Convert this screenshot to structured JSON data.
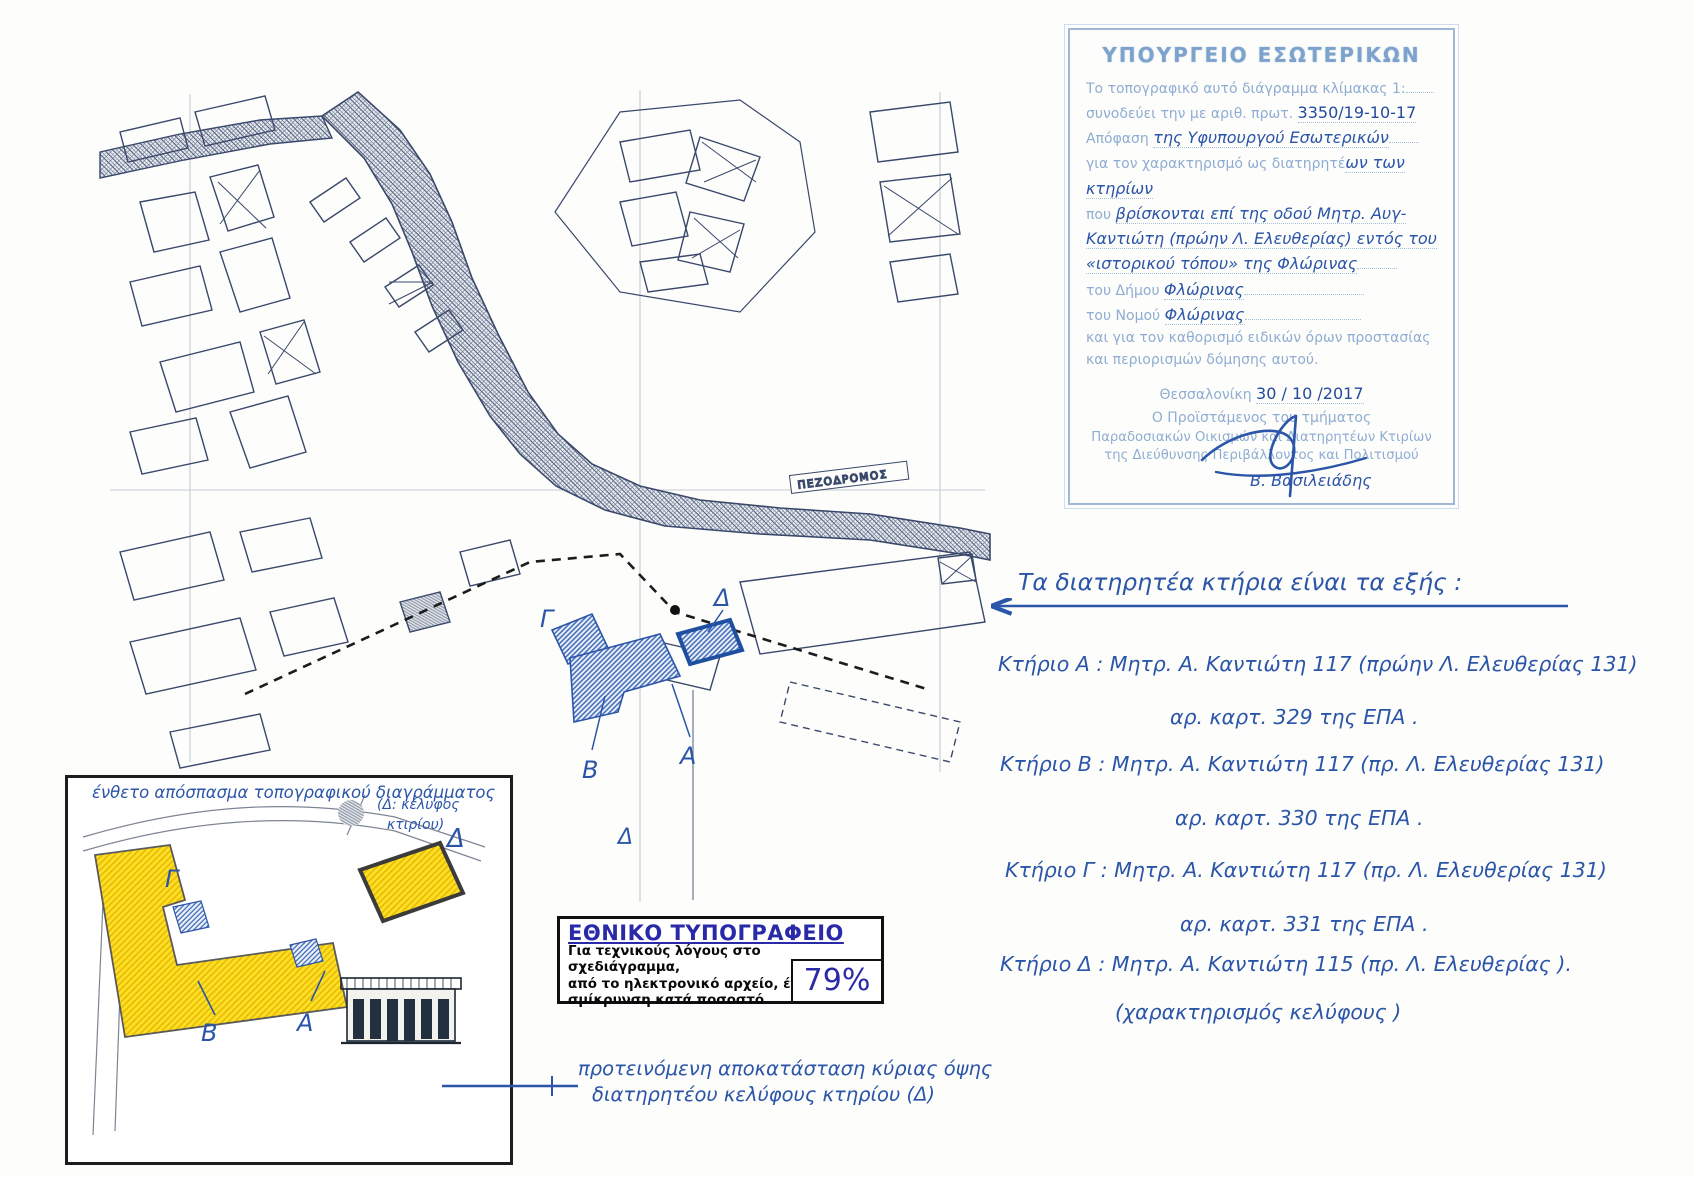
{
  "map": {
    "pezodromos_label": "ΠΕΖΟΔΡΟΜΟΣ",
    "labels": {
      "gamma": "Γ",
      "beta": "Β",
      "alpha": "Α",
      "delta": "Δ",
      "delta2": "Δ"
    }
  },
  "stamp": {
    "title": "ΥΠΟΥΡΓΕΙΟ ΕΣΩΤΕΡΙΚΩΝ",
    "l1": "Το τοπογραφικό αυτό διάγραμμα κλίμακας 1:",
    "l2_printed": "συνοδεύει την με αριθ. πρωτ.",
    "l2_hand": "3350/19-10-17",
    "l3_printed": "Απόφαση",
    "l3_hand": "της Υφυπουργού Εσωτερικών",
    "l4_printed": "για τον χαρακτηρισμό ως διατηρητέ",
    "l4_hand": "ων των κτηρίων",
    "l5_printed": "που",
    "l5_hand": "βρίσκονται επί της οδού Μητρ. Αυγ-",
    "l6_hand": "Καντιώτη (πρώην Λ. Ελευθερίας) εντός του",
    "l7_hand": "«ιστορικού τόπου» της Φλώρινας",
    "l8_printed": "του  Δήμου",
    "l8_hand": "Φλώρινας",
    "l9_printed": "του  Νομού",
    "l9_hand": "Φλώρινας",
    "l10": "και για τον καθορισμό ειδικών όρων προστασίας",
    "l11": "και περιορισμών δόμησης αυτού.",
    "date_printed": "Θεσσαλονίκη",
    "date_hand": "30 / 10 /2017",
    "sig1": "Ο Προϊστάμενος του τμήματος",
    "sig2": "Παραδοσιακών Οικισμών και Διατηρητέων Κτιρίων",
    "sig3": "της Διεύθυνσης Περιβάλλοντος και Πολιτισμού",
    "sig_name": "Β. Βασιλειάδης"
  },
  "notes": {
    "heading": "Τα διατηρητέα κτήρια είναι τα εξής :",
    "buildings": [
      {
        "line1": "Κτήριο Α : Μητρ. Α. Καντιώτη 117 (πρώην Λ. Ελευθερίας 131)",
        "line2": "αρ. καρτ. 329 της ΕΠΑ ."
      },
      {
        "line1": "Κτήριο Β : Μητρ. Α. Καντιώτη 117 (πρ. Λ. Ελευθερίας 131)",
        "line2": "αρ. καρτ. 330 της ΕΠΑ ."
      },
      {
        "line1": "Κτήριο Γ : Μητρ. Α. Καντιώτη 117 (πρ. Λ. Ελευθερίας 131)",
        "line2": "αρ. καρτ. 331 της ΕΠΑ ."
      },
      {
        "line1": "Κτήριο Δ : Μητρ. Α. Καντιώτη 115 (πρ. Λ. Ελευθερίας ).",
        "line2": "(χαρακτηρισμός κελύφους )"
      }
    ]
  },
  "inset": {
    "caption": "ένθετο απόσπασμα τοπογραφικού διαγράμματος",
    "delta_note_line1": "(Δ: κέλυφος",
    "delta_note_line2": "κτιρίου)",
    "labels": {
      "gamma": "Γ",
      "beta": "Β",
      "alpha": "Α",
      "delta": "Δ"
    }
  },
  "typography_box": {
    "title": "ΕΘΝΙΚΟ ΤΥΠΟΓΡΑΦΕΙΟ",
    "line1": "Για τεχνικούς λόγους στο σχεδιάγραμμα,",
    "line2": "από το ηλεκτρονικό αρχείο, έγινε",
    "line3": "σμίκρυνση κατά ποσοστό",
    "percent": "79%"
  },
  "restoration_note": {
    "line1": "προτεινόμενη αποκατάσταση κύριας όψης",
    "line2": "διατηρητέου κελύφους κτηρίου (Δ)"
  },
  "colors": {
    "handwriting_blue": "#2b55a8",
    "stamp_blue": "#8fadd3",
    "map_ink": "#39486b",
    "highlight_yellow": "#ffdf26",
    "typo_title_blue": "#2a2aa8"
  }
}
